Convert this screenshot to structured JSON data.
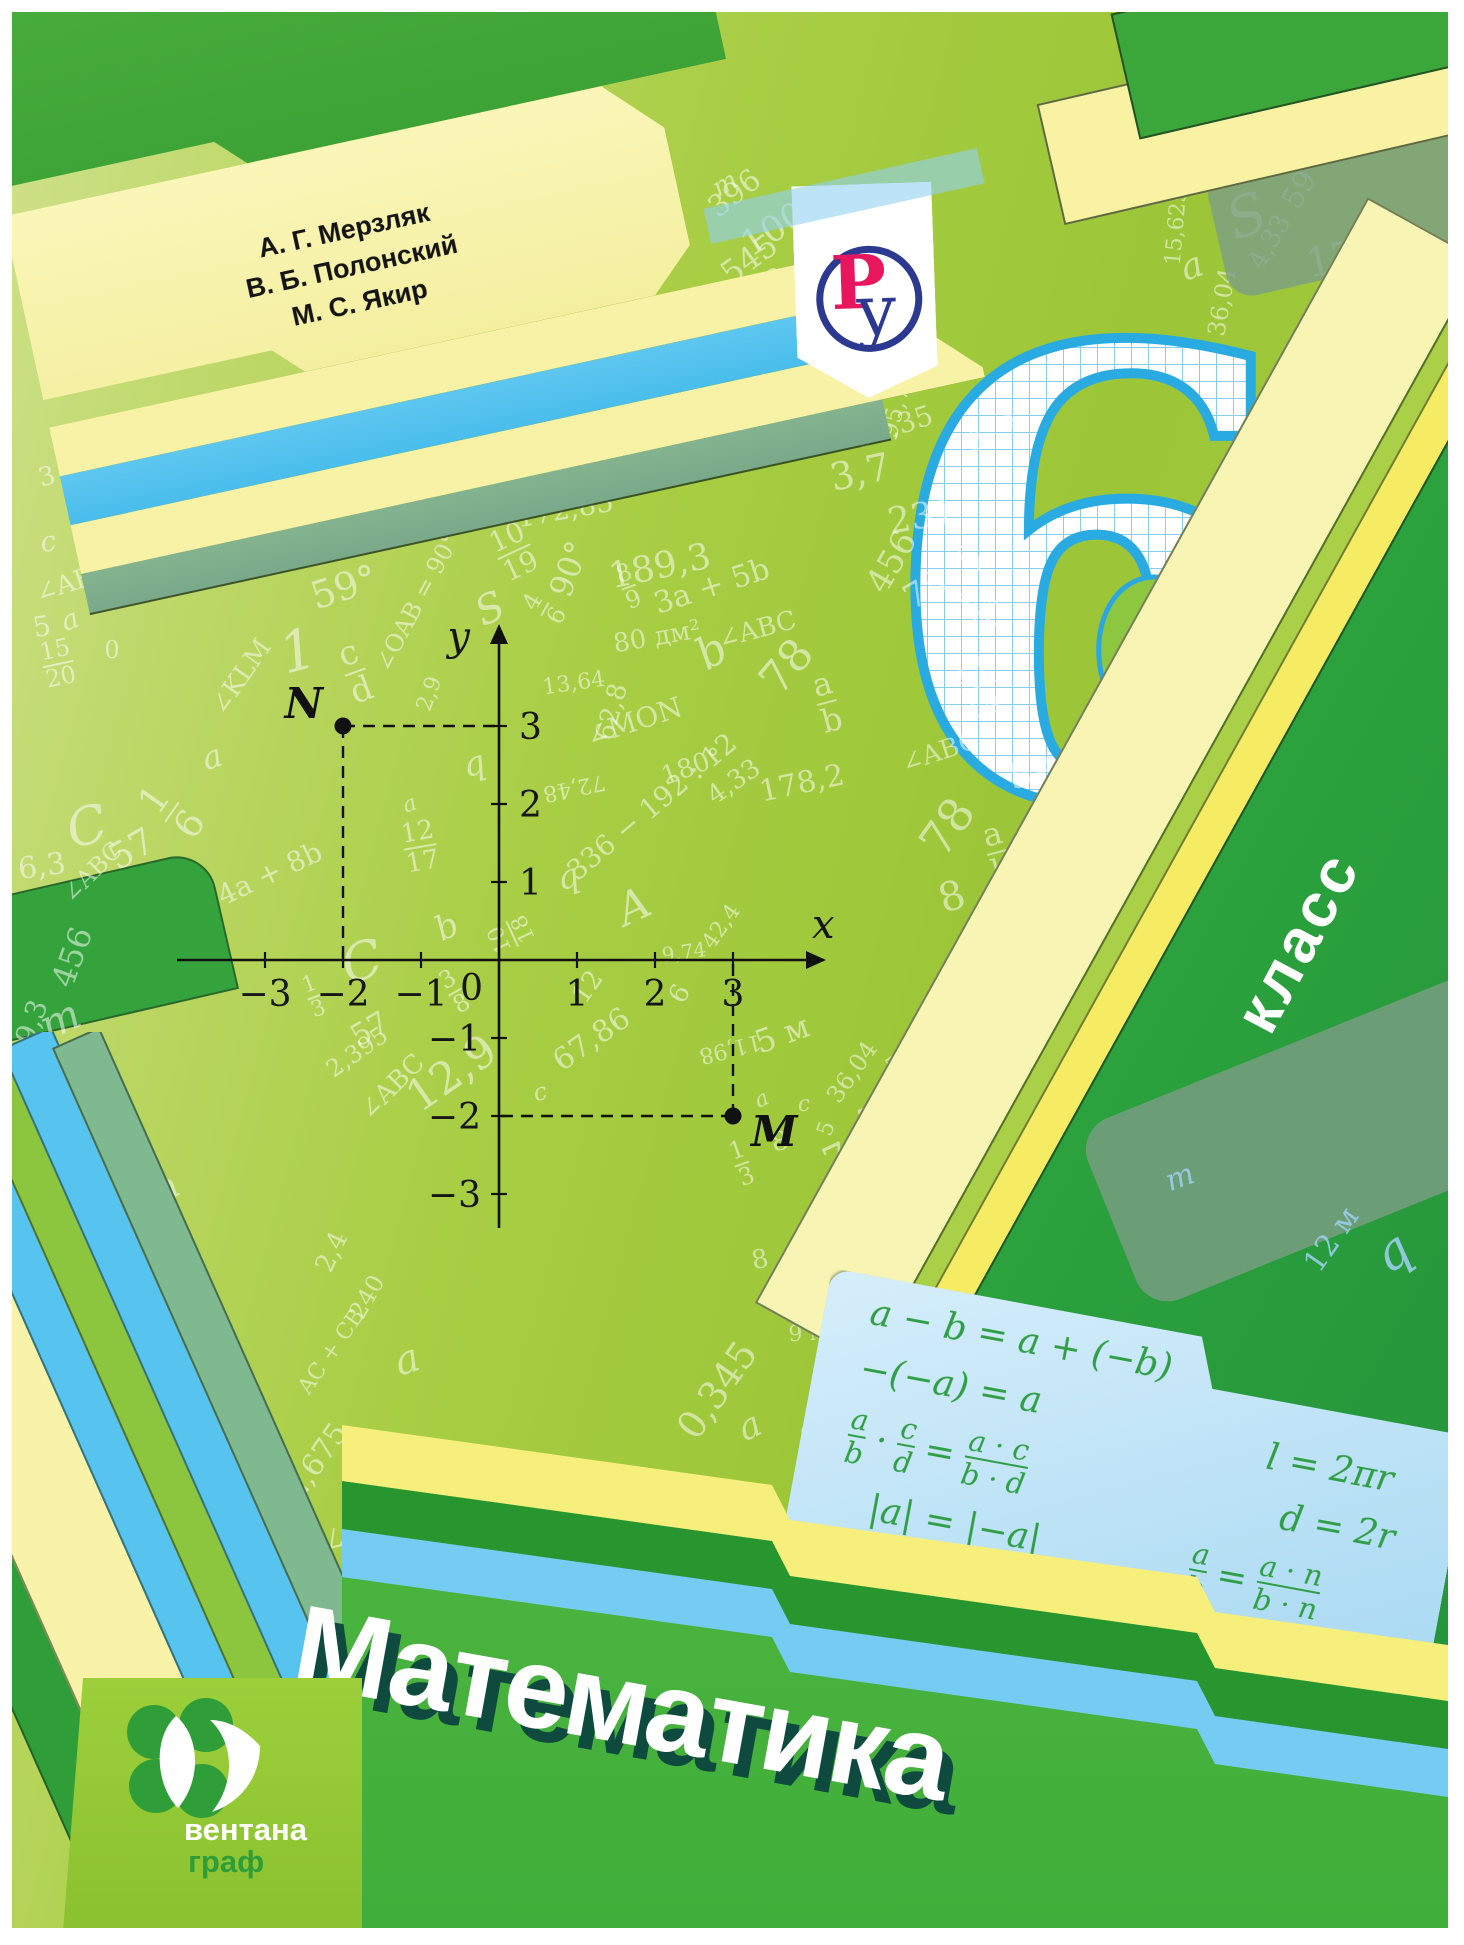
{
  "title": "Математика",
  "grade": {
    "number": "6",
    "label": "класс"
  },
  "authors": {
    "lines": [
      "А. Г. Мерзляк",
      "В. Б. Полонский",
      "М. С. Якир"
    ]
  },
  "publisher": {
    "name_top": "вентана",
    "name_bottom": "граф"
  },
  "publisher_mark": {
    "letter_p": "Р",
    "letter_u": "у"
  },
  "ellipse": {
    "num": "c",
    "den": "d"
  },
  "colors": {
    "background_green": "#a3ca40",
    "tab_green": "#4fb640",
    "dark_green": "#2f9e38",
    "pale_yellow": "#f8f3a8",
    "bright_yellow": "#f7ef7c",
    "sky_blue": "#57c4ef",
    "panel_blue": "#bfe3f7",
    "formula_green": "#2f9e44",
    "six_blue": "#29abe2",
    "logo_ring_blue": "#2b3990",
    "logo_p_red": "#e8175d",
    "title_shadow": "#0e4a3e"
  },
  "plot": {
    "x_label": "x",
    "y_label": "y",
    "origin_label": "0",
    "x_ticks": [
      -3,
      -2,
      -1,
      1,
      2,
      3
    ],
    "y_ticks": [
      3,
      2,
      1,
      -1,
      -2,
      -3
    ],
    "points": [
      {
        "label": "N",
        "x": -2,
        "y": 3
      },
      {
        "label": "M",
        "x": 3,
        "y": -2
      }
    ]
  },
  "panel": {
    "col1": [
      [
        "a − b = a + (−b)"
      ],
      [
        "−(−a) = a"
      ],
      [
        [
          "a",
          "b"
        ],
        "·",
        [
          "c",
          "d"
        ],
        "=",
        [
          "a · c",
          "b · d"
        ]
      ],
      [
        "|a| = |−a|"
      ]
    ],
    "col2": [
      [
        "l = 2πr"
      ],
      [
        "d = 2r"
      ],
      [
        [
          "a",
          "b"
        ],
        "=",
        [
          "a · n",
          "b · n"
        ]
      ],
      [
        [
          "a",
          "b"
        ],
        ":",
        [
          "c",
          "d"
        ],
        "=",
        [
          "a · d",
          "b · c"
        ]
      ]
    ]
  },
  "scatter": [
    {
      "t": "1,50",
      "x": 545,
      "y": 100,
      "r": -70,
      "s": 26
    },
    {
      "t": "396",
      "x": 723,
      "y": 182,
      "r": -38,
      "s": 30
    },
    {
      "t": "100",
      "x": 762,
      "y": 218,
      "r": -32,
      "s": 36
    },
    {
      "t": "545",
      "x": 737,
      "y": 247,
      "r": -36,
      "s": 32
    },
    {
      "t": "128",
      "x": 750,
      "y": 278,
      "r": -38,
      "s": 28
    },
    {
      "t": "m",
      "x": 713,
      "y": 172,
      "r": -30,
      "s": 26,
      "i": 1
    },
    {
      "t": "1,8",
      "x": 706,
      "y": 312,
      "r": -78,
      "s": 26
    },
    {
      "t": "6",
      "x": 660,
      "y": 352,
      "r": -15,
      "s": 28
    },
    {
      "t": "6,3",
      "x": 742,
      "y": 378,
      "r": -42,
      "s": 28
    },
    {
      "t": "9,8",
      "x": 802,
      "y": 382,
      "r": -28,
      "s": 28
    },
    {
      "t": "3,7",
      "x": 745,
      "y": 418,
      "r": -12,
      "s": 30
    },
    {
      "t": "91,35",
      "x": 882,
      "y": 415,
      "r": -18,
      "s": 28
    },
    {
      "t": "95,72",
      "x": 885,
      "y": 392,
      "r": -75,
      "s": 24
    },
    {
      "t": "95,72",
      "x": 612,
      "y": 398,
      "r": -75,
      "s": 22
    },
    {
      "t": "0,801",
      "x": 510,
      "y": 390,
      "r": -80,
      "s": 24
    },
    {
      "t": "172,85",
      "x": 447,
      "y": 398,
      "r": -10,
      "s": 32
    },
    {
      "t": "172,85",
      "x": 553,
      "y": 498,
      "r": -10,
      "s": 28
    },
    {
      "t": "59°",
      "x": 332,
      "y": 575,
      "r": -18,
      "s": 38
    },
    {
      "t": "∠OAB = 90°",
      "x": 405,
      "y": 590,
      "r": -62,
      "s": 24
    },
    {
      "t": "10|19",
      "x": 502,
      "y": 540,
      "r": -25,
      "s": 28
    },
    {
      "t": "90°",
      "x": 557,
      "y": 557,
      "r": -70,
      "s": 32
    },
    {
      "t": "S",
      "x": 478,
      "y": 597,
      "r": -25,
      "s": 40,
      "i": 1
    },
    {
      "t": "4|6",
      "x": 533,
      "y": 597,
      "r": -60,
      "s": 24
    },
    {
      "t": "8|9",
      "x": 617,
      "y": 575,
      "r": -20,
      "s": 24
    },
    {
      "t": "80 дм²",
      "x": 645,
      "y": 625,
      "r": -10,
      "s": 26
    },
    {
      "t": "13,64",
      "x": 562,
      "y": 672,
      "r": -8,
      "s": 22
    },
    {
      "t": "∠MON",
      "x": 622,
      "y": 710,
      "r": -18,
      "s": 28
    },
    {
      "t": "2,9",
      "x": 418,
      "y": 682,
      "r": -70,
      "s": 22
    },
    {
      "t": "c|d",
      "x": 343,
      "y": 660,
      "r": -20,
      "s": 34
    },
    {
      "t": "1",
      "x": 286,
      "y": 640,
      "r": -15,
      "s": 56,
      "i": 1
    },
    {
      "t": "∠KLM",
      "x": 229,
      "y": 665,
      "r": -55,
      "s": 26
    },
    {
      "t": "∠ABC",
      "x": 62,
      "y": 570,
      "r": -18,
      "s": 26
    },
    {
      "t": "a",
      "x": 200,
      "y": 745,
      "r": -18,
      "s": 32,
      "i": 1
    },
    {
      "t": "c",
      "x": 36,
      "y": 530,
      "r": -10,
      "s": 28,
      "i": 1
    },
    {
      "t": "0",
      "x": 100,
      "y": 638,
      "r": 0,
      "s": 24
    },
    {
      "t": "5",
      "x": 30,
      "y": 615,
      "r": -10,
      "s": 28
    },
    {
      "t": "15|20",
      "x": 46,
      "y": 652,
      "r": -12,
      "s": 24
    },
    {
      "t": "1|6",
      "x": 160,
      "y": 800,
      "r": -55,
      "s": 38
    },
    {
      "t": "4a + 8b",
      "x": 258,
      "y": 862,
      "r": -25,
      "s": 28
    },
    {
      "t": "12|17",
      "x": 408,
      "y": 835,
      "r": -10,
      "s": 26
    },
    {
      "t": "q",
      "x": 462,
      "y": 752,
      "r": -15,
      "s": 34,
      "i": 1
    },
    {
      "t": "a",
      "x": 398,
      "y": 793,
      "r": -20,
      "s": 22,
      "i": 1
    },
    {
      "t": "b",
      "x": 435,
      "y": 915,
      "r": -25,
      "s": 34,
      "i": 1
    },
    {
      "t": "12,9",
      "x": 440,
      "y": 1062,
      "r": -35,
      "s": 44
    },
    {
      "t": "57",
      "x": 120,
      "y": 838,
      "r": -30,
      "s": 36
    },
    {
      "t": "57",
      "x": 358,
      "y": 1018,
      "r": -30,
      "s": 30
    },
    {
      "t": "336 − 192 : 12",
      "x": 640,
      "y": 795,
      "r": -40,
      "s": 28
    },
    {
      "t": "72,48",
      "x": 562,
      "y": 775,
      "r": 168,
      "s": 22
    },
    {
      "t": "C",
      "x": 75,
      "y": 815,
      "r": -15,
      "s": 52,
      "i": 1
    },
    {
      "t": "C",
      "x": 350,
      "y": 950,
      "r": -15,
      "s": 52,
      "i": 1
    },
    {
      "t": "q",
      "x": 556,
      "y": 865,
      "r": -15,
      "s": 34,
      "i": 1
    },
    {
      "t": "A",
      "x": 622,
      "y": 895,
      "r": -25,
      "s": 44,
      "i": 1
    },
    {
      "t": "42,4",
      "x": 710,
      "y": 915,
      "r": -55,
      "s": 22
    },
    {
      "t": "c",
      "x": 528,
      "y": 1080,
      "r": -15,
      "s": 24,
      "i": 1
    },
    {
      "t": "12",
      "x": 576,
      "y": 975,
      "r": -55,
      "s": 26
    },
    {
      "t": "67,86",
      "x": 580,
      "y": 1028,
      "r": -35,
      "s": 30
    },
    {
      "t": "6",
      "x": 668,
      "y": 982,
      "r": -60,
      "s": 26
    },
    {
      "t": "10|18",
      "x": 500,
      "y": 922,
      "r": -115,
      "s": 22
    },
    {
      "t": "3|8",
      "x": 443,
      "y": 980,
      "r": -30,
      "s": 24
    },
    {
      "t": "∠ABC",
      "x": 380,
      "y": 1075,
      "r": -45,
      "s": 26
    },
    {
      "t": "∠ABC",
      "x": 80,
      "y": 860,
      "r": -45,
      "s": 24
    },
    {
      "t": "11,98",
      "x": 718,
      "y": 1036,
      "r": 166,
      "s": 22
    },
    {
      "t": "5 м",
      "x": 770,
      "y": 1022,
      "r": -20,
      "s": 32
    },
    {
      "t": "36,04",
      "x": 840,
      "y": 1060,
      "r": -55,
      "s": 24
    },
    {
      "t": "59",
      "x": 888,
      "y": 1050,
      "r": -35,
      "s": 22
    },
    {
      "t": "80",
      "x": 938,
      "y": 1035,
      "r": -30,
      "s": 30
    },
    {
      "t": "545",
      "x": 1010,
      "y": 1048,
      "r": -22,
      "s": 30
    },
    {
      "t": "96",
      "x": 1075,
      "y": 1080,
      "r": -50,
      "s": 28
    },
    {
      "t": "м",
      "x": 1052,
      "y": 1058,
      "r": -40,
      "s": 24
    },
    {
      "t": "128",
      "x": 1008,
      "y": 1098,
      "r": -30,
      "s": 26
    },
    {
      "t": "59",
      "x": 1066,
      "y": 1115,
      "r": -55,
      "s": 22
    },
    {
      "t": "c",
      "x": 792,
      "y": 1093,
      "r": -5,
      "s": 22,
      "i": 1
    },
    {
      "t": "a",
      "x": 750,
      "y": 1088,
      "r": -25,
      "s": 22,
      "i": 1
    },
    {
      "t": "8",
      "x": 768,
      "y": 1130,
      "r": -10,
      "s": 26
    },
    {
      "t": "5",
      "x": 815,
      "y": 1117,
      "r": -70,
      "s": 22
    },
    {
      "t": "3",
      "x": 855,
      "y": 1108,
      "r": -12,
      "s": 32
    },
    {
      "t": "6",
      "x": 905,
      "y": 1100,
      "r": -8,
      "s": 26
    },
    {
      "t": "8,1",
      "x": 938,
      "y": 1112,
      "r": -100,
      "s": 24
    },
    {
      "t": "1|3",
      "x": 730,
      "y": 1152,
      "r": -20,
      "s": 24
    },
    {
      "t": "7",
      "x": 825,
      "y": 1148,
      "r": -25,
      "s": 40
    },
    {
      "t": "4",
      "x": 890,
      "y": 1158,
      "r": -15,
      "s": 48
    },
    {
      "t": "6,3",
      "x": 942,
      "y": 1163,
      "r": -12,
      "s": 26
    },
    {
      "t": "m",
      "x": 977,
      "y": 1153,
      "r": -55,
      "s": 26,
      "i": 1
    },
    {
      "t": "150",
      "x": 1038,
      "y": 1160,
      "r": -8,
      "s": 36
    },
    {
      "t": "67,86",
      "x": 1120,
      "y": 1190,
      "r": -35,
      "s": 40
    },
    {
      "t": "2",
      "x": 857,
      "y": 1192,
      "r": -18,
      "s": 30
    },
    {
      "t": "1",
      "x": 828,
      "y": 1210,
      "r": -30,
      "s": 28,
      "i": 1
    },
    {
      "t": "0",
      "x": 880,
      "y": 1232,
      "r": -8,
      "s": 26
    },
    {
      "t": "3,7",
      "x": 922,
      "y": 1216,
      "r": -55,
      "s": 26
    },
    {
      "t": "9,8",
      "x": 970,
      "y": 1208,
      "r": -15,
      "s": 28
    },
    {
      "t": "∠CDE",
      "x": 1045,
      "y": 1200,
      "r": -45,
      "s": 24
    },
    {
      "t": "a",
      "x": 998,
      "y": 1238,
      "r": -20,
      "s": 26,
      "i": 1
    },
    {
      "t": "8",
      "x": 748,
      "y": 1248,
      "r": -12,
      "s": 26
    },
    {
      "t": "9",
      "x": 795,
      "y": 1270,
      "r": -8,
      "s": 40
    },
    {
      "t": "b",
      "x": 830,
      "y": 1255,
      "r": -25,
      "s": 24,
      "i": 1
    },
    {
      "t": "0",
      "x": 865,
      "y": 1275,
      "r": -8,
      "s": 24
    },
    {
      "t": "72 дм",
      "x": 895,
      "y": 1285,
      "r": -25,
      "s": 22
    },
    {
      "t": "91,35",
      "x": 1028,
      "y": 1275,
      "r": -8,
      "s": 26
    },
    {
      "t": "36,04",
      "x": 1140,
      "y": 1260,
      "r": -18,
      "s": 26
    },
    {
      "t": "75",
      "x": 1132,
      "y": 1298,
      "r": -60,
      "s": 32
    },
    {
      "t": "15,625",
      "x": 1415,
      "y": 1368,
      "r": 163,
      "s": 20
    },
    {
      "t": "13|17",
      "x": 1318,
      "y": 1357,
      "r": -60,
      "s": 20
    },
    {
      "t": "72,48",
      "x": 1272,
      "y": 1313,
      "r": -15,
      "s": 26
    },
    {
      "t": "396",
      "x": 1203,
      "y": 1318,
      "r": -8,
      "s": 22
    },
    {
      "t": "240",
      "x": 1203,
      "y": 1268,
      "r": -40,
      "s": 26
    },
    {
      "t": "d",
      "x": 1262,
      "y": 1262,
      "r": -30,
      "s": 48,
      "i": 1
    },
    {
      "t": "5 м³",
      "x": 1228,
      "y": 1210,
      "r": -20,
      "s": 34
    },
    {
      "t": "12 м",
      "x": 1320,
      "y": 1228,
      "r": -55,
      "s": 30,
      "c": 1
    },
    {
      "t": "q",
      "x": 1380,
      "y": 1240,
      "r": -35,
      "s": 50,
      "i": 1,
      "c": 1
    },
    {
      "t": "m",
      "x": 1168,
      "y": 1166,
      "r": -20,
      "s": 30,
      "i": 1,
      "c": 1
    },
    {
      "t": "67,86",
      "x": 1378,
      "y": 1282,
      "r": -35,
      "s": 30
    },
    {
      "t": "a",
      "x": 1393,
      "y": 1328,
      "r": -20,
      "s": 24,
      "i": 1
    },
    {
      "t": "S",
      "x": 1235,
      "y": 205,
      "r": -20,
      "s": 56,
      "i": 1
    },
    {
      "t": "175",
      "x": 1332,
      "y": 245,
      "r": -12,
      "s": 40
    },
    {
      "t": "178,2",
      "x": 1388,
      "y": 275,
      "r": -18,
      "s": 28
    },
    {
      "t": "4,33",
      "x": 1258,
      "y": 230,
      "r": -60,
      "s": 26
    },
    {
      "t": "a",
      "x": 1180,
      "y": 255,
      "r": -20,
      "s": 36,
      "i": 1
    },
    {
      "t": "c",
      "x": 1205,
      "y": 160,
      "r": -15,
      "s": 30,
      "i": 1
    },
    {
      "t": "36,04",
      "x": 1210,
      "y": 290,
      "r": -80,
      "s": 24
    },
    {
      "t": "15,625",
      "x": 1165,
      "y": 215,
      "r": -85,
      "s": 22
    },
    {
      "t": "p",
      "x": 1432,
      "y": 285,
      "r": -15,
      "s": 40,
      "i": 1
    },
    {
      "t": "545",
      "x": 1382,
      "y": 360,
      "r": -12,
      "s": 38
    },
    {
      "t": "1,8",
      "x": 1300,
      "y": 390,
      "r": -85,
      "s": 26
    },
    {
      "t": "128",
      "x": 1396,
      "y": 415,
      "r": -8,
      "s": 28
    },
    {
      "t": "m",
      "x": 1350,
      "y": 420,
      "r": -25,
      "s": 24,
      "i": 1
    },
    {
      "t": "91,35",
      "x": 1342,
      "y": 525,
      "r": -55,
      "s": 26
    },
    {
      "t": "c|d",
      "x": 1398,
      "y": 558,
      "r": -12,
      "s": 38
    },
    {
      "t": "11|14",
      "x": 965,
      "y": 675,
      "r": -20,
      "s": 32
    },
    {
      "t": "9|12",
      "x": 970,
      "y": 595,
      "r": -60,
      "s": 24
    },
    {
      "t": "78",
      "x": 913,
      "y": 578,
      "r": -30,
      "s": 34
    },
    {
      "t": "∠ABC",
      "x": 928,
      "y": 740,
      "r": -18,
      "s": 26
    },
    {
      "t": "59",
      "x": 1020,
      "y": 762,
      "r": -12,
      "s": 36
    },
    {
      "t": "78",
      "x": 935,
      "y": 815,
      "r": -55,
      "s": 46
    },
    {
      "t": "a|b",
      "x": 985,
      "y": 840,
      "r": -15,
      "s": 32
    },
    {
      "t": "8",
      "x": 940,
      "y": 885,
      "r": -18,
      "s": 40
    },
    {
      "t": "0,801",
      "x": 1040,
      "y": 848,
      "r": -55,
      "s": 26
    },
    {
      "t": "178,2",
      "x": 998,
      "y": 920,
      "r": -25,
      "s": 34
    },
    {
      "t": "b",
      "x": 1055,
      "y": 945,
      "r": -30,
      "s": 26,
      "i": 1
    },
    {
      "t": "175",
      "x": 1053,
      "y": 1004,
      "r": -8,
      "s": 26
    },
    {
      "t": "91,35",
      "x": 1175,
      "y": 608,
      "r": -30,
      "s": 24
    },
    {
      "t": "231",
      "x": 910,
      "y": 505,
      "r": -10,
      "s": 36
    },
    {
      "t": "456",
      "x": 880,
      "y": 550,
      "r": -60,
      "s": 34
    },
    {
      "t": "5",
      "x": 958,
      "y": 548,
      "r": -18,
      "s": 42
    },
    {
      "t": "3,7",
      "x": 848,
      "y": 460,
      "r": -12,
      "s": 38
    },
    {
      "t": "189,3",
      "x": 648,
      "y": 555,
      "r": -12,
      "s": 36
    },
    {
      "t": "59",
      "x": 1288,
      "y": 178,
      "r": -60,
      "s": 30
    },
    {
      "t": "3",
      "x": 35,
      "y": 465,
      "r": -15,
      "s": 26
    },
    {
      "t": "a",
      "x": 58,
      "y": 608,
      "r": -20,
      "s": 28,
      "i": 1
    },
    {
      "t": "6,3",
      "x": 30,
      "y": 855,
      "r": -8,
      "s": 30
    },
    {
      "t": "m",
      "x": 48,
      "y": 1008,
      "r": -25,
      "s": 42,
      "i": 1
    },
    {
      "t": "456",
      "x": 60,
      "y": 945,
      "r": -70,
      "s": 32
    },
    {
      "t": "9,3",
      "x": 20,
      "y": 1010,
      "r": -70,
      "s": 28
    },
    {
      "t": "1|3",
      "x": 302,
      "y": 985,
      "r": -20,
      "s": 22
    },
    {
      "t": "2,395",
      "x": 345,
      "y": 1040,
      "r": -35,
      "s": 24
    },
    {
      "t": "80 дм²",
      "x": 808,
      "y": 1385,
      "r": -78,
      "s": 26
    },
    {
      "t": "9 м²",
      "x": 800,
      "y": 1322,
      "r": -3,
      "s": 22
    },
    {
      "t": "0,345",
      "x": 705,
      "y": 1378,
      "r": -55,
      "s": 38
    },
    {
      "t": "a",
      "x": 738,
      "y": 1415,
      "r": -25,
      "s": 36,
      "i": 1
    },
    {
      "t": "2,675",
      "x": 305,
      "y": 1450,
      "r": -55,
      "s": 30
    },
    {
      "t": "58",
      "x": 245,
      "y": 1495,
      "r": -55,
      "s": 26
    },
    {
      "t": "172,85",
      "x": 302,
      "y": 1530,
      "r": 165,
      "s": 26
    },
    {
      "t": "0",
      "x": 278,
      "y": 1605,
      "r": -70,
      "s": 20
    },
    {
      "t": "8",
      "x": 322,
      "y": 1612,
      "r": -75,
      "s": 20
    },
    {
      "t": "6",
      "x": 250,
      "y": 1648,
      "r": -70,
      "s": 20
    },
    {
      "t": "AC + CB",
      "x": 320,
      "y": 1340,
      "r": -55,
      "s": 22
    },
    {
      "t": "a",
      "x": 395,
      "y": 1348,
      "r": -18,
      "s": 40,
      "i": 1
    },
    {
      "t": "2,4",
      "x": 320,
      "y": 1240,
      "r": -65,
      "s": 26
    },
    {
      "t": "240",
      "x": 355,
      "y": 1285,
      "r": -60,
      "s": 24
    },
    {
      "t": "456",
      "x": 90,
      "y": 1235,
      "r": -70,
      "s": 30
    },
    {
      "t": "m",
      "x": 150,
      "y": 1180,
      "r": -30,
      "s": 36,
      "i": 1
    },
    {
      "t": "9,74",
      "x": 672,
      "y": 940,
      "r": -8,
      "s": 20
    },
    {
      "t": "62,8",
      "x": 600,
      "y": 700,
      "r": -75,
      "s": 26
    },
    {
      "t": "180°",
      "x": 680,
      "y": 755,
      "r": -20,
      "s": 26
    },
    {
      "t": "4,33",
      "x": 722,
      "y": 770,
      "r": -35,
      "s": 26
    },
    {
      "t": "178,2",
      "x": 790,
      "y": 772,
      "r": -12,
      "s": 30
    },
    {
      "t": "3a + 5b",
      "x": 700,
      "y": 575,
      "r": -18,
      "s": 30
    },
    {
      "t": "∠ABC",
      "x": 745,
      "y": 618,
      "r": -15,
      "s": 26
    },
    {
      "t": "b",
      "x": 700,
      "y": 640,
      "r": -30,
      "s": 44,
      "i": 1
    },
    {
      "t": "78",
      "x": 775,
      "y": 655,
      "r": -50,
      "s": 44
    },
    {
      "t": "a|b",
      "x": 815,
      "y": 690,
      "r": -15,
      "s": 32
    },
    {
      "t": "4,5",
      "x": 803,
      "y": 422,
      "r": -60,
      "s": 22
    },
    {
      "t": "0",
      "x": 963,
      "y": 430,
      "r": -10,
      "s": 26
    },
    {
      "t": "4",
      "x": 1000,
      "y": 410,
      "r": -45,
      "s": 28
    }
  ]
}
